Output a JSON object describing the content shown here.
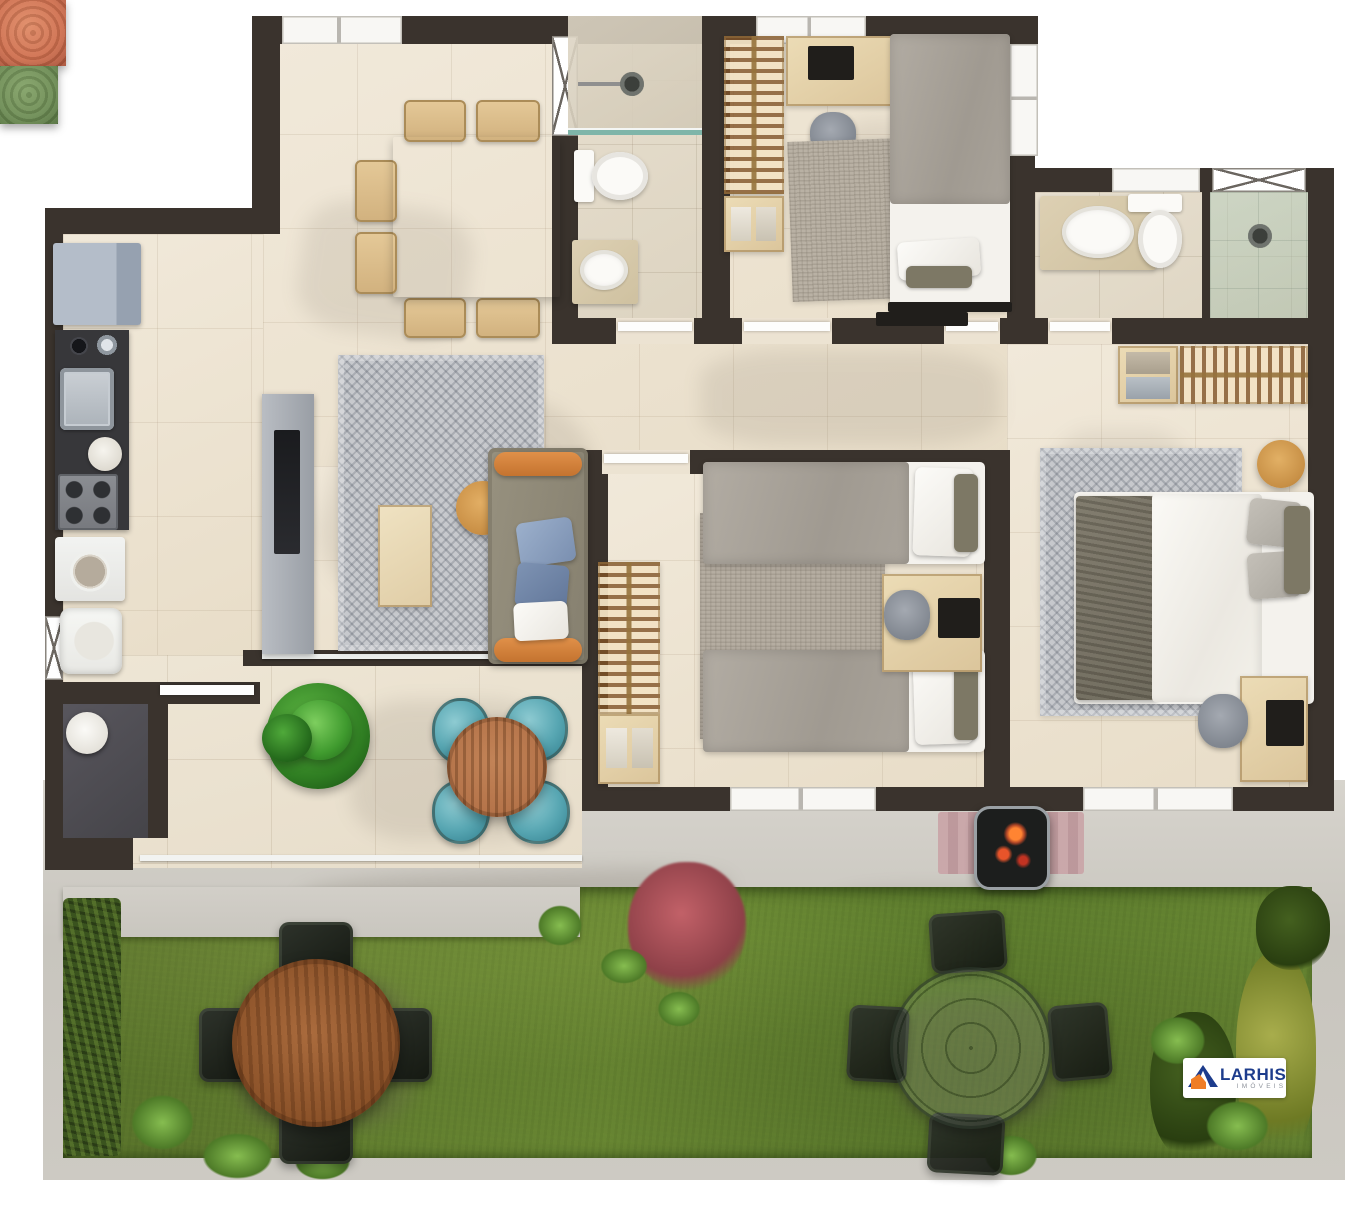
{
  "scene": {
    "type": "3d-floor-plan-top-view",
    "width_px": 1366,
    "height_px": 1209,
    "description": "Furnished apartment floor plan render with private garden"
  },
  "brand": {
    "name": "LARHIS",
    "tagline": "IMÓVEIS",
    "name_color": "#1d3c8c",
    "tagline_color": "#8f949c",
    "house_icon": {
      "roof_color": "#1d3c8c",
      "body_color": "#ef7d26"
    }
  },
  "palette": {
    "wall": "#3a332d",
    "floor_cream": "#ece3d2",
    "bath_floor": "#e3dbca",
    "terrace_floor": "#ebe2d1",
    "pavement": "#cbc8c1",
    "grass": "#5e7c2e",
    "hedge": "#3a531e",
    "wc_floor": "#514f55",
    "wood_light": "#dcc59b",
    "wood_table": "#8a5128",
    "wood_rail_hangers": "#80522a",
    "sofa": "#8f897b",
    "sofa_bolster_orange": "#d8833c",
    "pillow_blue": "#8fa3c2",
    "petal_chair_blue": "#57a6b2",
    "pouf_orange": "#cf6f4e",
    "pouf_green": "#6e8d55",
    "rug_gray": "#c6c8cc",
    "rug_speckle": "#b9b1a4",
    "duvet_gray": "#a8a29a",
    "fridge": "#aab3c0",
    "counter_dark": "#37373a",
    "bbq_embers": "#e8542a"
  },
  "rooms": [
    {
      "id": "kitchen"
    },
    {
      "id": "dining-room"
    },
    {
      "id": "bathroom-1"
    },
    {
      "id": "bedroom-1"
    },
    {
      "id": "suite-bathroom"
    },
    {
      "id": "master-bedroom"
    },
    {
      "id": "living-room"
    },
    {
      "id": "bedroom-2"
    },
    {
      "id": "laundry"
    },
    {
      "id": "wc"
    },
    {
      "id": "terrace"
    },
    {
      "id": "garden"
    }
  ],
  "furniture_inventory": {
    "kitchen": [
      "fridge",
      "counter-with-sink",
      "cooktop",
      "washing-machine",
      "laundry-tank",
      "wc-sink"
    ],
    "dining-room": [
      "square-table-set-for-four",
      "six-wood-chairs",
      "plates",
      "placemats"
    ],
    "bathroom-1": [
      "shower",
      "glass-screen",
      "toilet",
      "vanity-sink",
      "x-window"
    ],
    "bedroom-1": [
      "wardrobe-open-rail",
      "towel-shelf",
      "desk-with-laptop",
      "desk-chair",
      "single-bed",
      "rug",
      "tv"
    ],
    "suite-bathroom": [
      "vanity-sink",
      "toilet",
      "shower",
      "x-window"
    ],
    "master-bedroom": [
      "wardrobe-open-rail",
      "baskets",
      "round-side-table",
      "double-bed",
      "herringbone-rug",
      "desk-with-laptop",
      "desk-chair"
    ],
    "living-room": [
      "tv-sideboard",
      "tv",
      "chevron-rug",
      "coffee-bench",
      "round-wood-side-table",
      "sofa-with-orange-bolsters",
      "blue-pillows"
    ],
    "bedroom-2": [
      "wardrobe-open-rail",
      "towel-shelf",
      "two-single-beds",
      "shared-desk-with-laptop",
      "desk-chair",
      "rug"
    ],
    "terrace": [
      "potted-plant",
      "flower-lounge-set-blue-petal-chairs",
      "round-wood-table",
      "glass-railing"
    ],
    "garden": [
      "round-wood-dining-table",
      "four-black-chairs",
      "orange-pouf",
      "green-pouf",
      "glass-round-table",
      "four-mesh-chairs",
      "bbq-grill",
      "striped-mat",
      "hedges",
      "red-bush",
      "olive-bush",
      "ferns"
    ]
  }
}
